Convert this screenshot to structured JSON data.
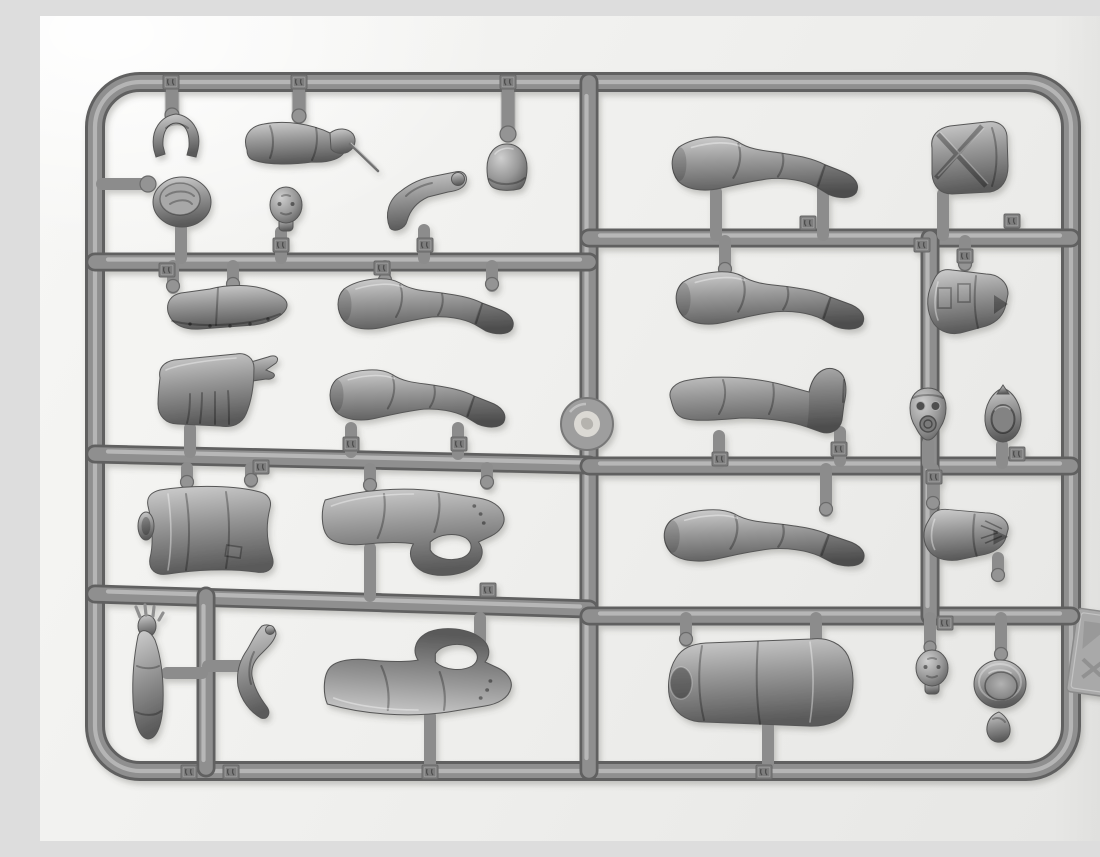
{
  "meta": {
    "title": "Grey plastic model-kit figure sprue",
    "description": "Top-down photograph of a grey styrene injection-moulded sprue frame holding unassembled model-figure parts (legs, arms, torsos, heads, caps and helmets) joined to round runners by short gates; small embossed part-number tags sit on the runners but their digits are not legible."
  },
  "colors": {
    "background_light": "#f7f7f5",
    "background": "#efefed",
    "background_dark": "#e6e6e4",
    "tube_dark": "#616161",
    "tube_mid": "#8f8f8f",
    "tube_hi": "#c1c1c1",
    "part_light": "#cfcfcf",
    "part_mid": "#989898",
    "part_dark": "#5a5a5a",
    "tag": "#7d7d7d",
    "tab": "#a9a9a9",
    "disc_center": "#dbd9d4"
  },
  "sprue": {
    "material": "grey styrene plastic",
    "layout": "rounded-rectangle outer frame with one full-height centre runner, three left-hand cross runners, two right-hand cross runners and two short vertical sub-runners",
    "counts": {
      "parts": 28,
      "number_tags": 24
    },
    "parts": [
      {
        "id": "cap-curved-part",
        "name": "curved cap / visor part"
      },
      {
        "id": "arm-with-cigarette",
        "name": "arm holding a thin cigarette or stick"
      },
      {
        "id": "peaked-cap",
        "name": "peaked service cap seen from above"
      },
      {
        "id": "bare-head",
        "name": "moulded head"
      },
      {
        "id": "bent-arm",
        "name": "bent arm with fist"
      },
      {
        "id": "helmet",
        "name": "helmet dome"
      },
      {
        "id": "ankle-boot",
        "name": "shoe / lower-leg part with riveted sole"
      },
      {
        "id": "leg-left-upper",
        "name": "booted leg lying horizontally"
      },
      {
        "id": "tunic-back",
        "name": "tunic back with pointed strap end and skirt pleats"
      },
      {
        "id": "leg-left-lower",
        "name": "booted leg lying horizontally"
      },
      {
        "id": "tunic-front",
        "name": "tunic torso with arm socket"
      },
      {
        "id": "arm-hand-tucked-upper",
        "name": "large sleeved arm bent with hand tucked, open gap at elbow"
      },
      {
        "id": "arm-raised-open-hand",
        "name": "vertical arm with raised open hand"
      },
      {
        "id": "arm-bent-small",
        "name": "small sharply bent arm"
      },
      {
        "id": "arm-hand-tucked-lower",
        "name": "large sleeved arm bent with hand tucked, open gap at elbow"
      },
      {
        "id": "greatcoat-torso",
        "name": "greatcoat torso lying horizontally with arm socket"
      },
      {
        "id": "head-face",
        "name": "head with detailed face"
      },
      {
        "id": "helmet-interior",
        "name": "helmet bowl seen from inside"
      },
      {
        "id": "small-pouch",
        "name": "small teardrop-shaped part"
      },
      {
        "id": "leg-right-top",
        "name": "booted leg lying horizontally"
      },
      {
        "id": "bedroll",
        "name": "rolled pack / bedroll with crossed straps"
      },
      {
        "id": "leg-right-middle",
        "name": "booted leg lying horizontally"
      },
      {
        "id": "tunic-pockets",
        "name": "tunic torso with patch pockets and collar notch"
      },
      {
        "id": "leg-boot-raised",
        "name": "booted leg with toe pointing upward"
      },
      {
        "id": "head-gas-mask",
        "name": "head wearing a gas mask with round filter"
      },
      {
        "id": "hood-part",
        "name": "hollow egg-shaped hood part"
      },
      {
        "id": "leg-right-lower",
        "name": "booted leg lying horizontally"
      },
      {
        "id": "tunic-laced",
        "name": "tunic torso with lacing at one end"
      }
    ],
    "features": {
      "injection_disc": "round sprue gate disc with pale centre at the middle of the centre runner",
      "mold_tab": "flat rectangular moulding tab protruding from the right frame edge",
      "number_tags": "small square embossed part-number tags on runners, digits too small to read"
    }
  }
}
